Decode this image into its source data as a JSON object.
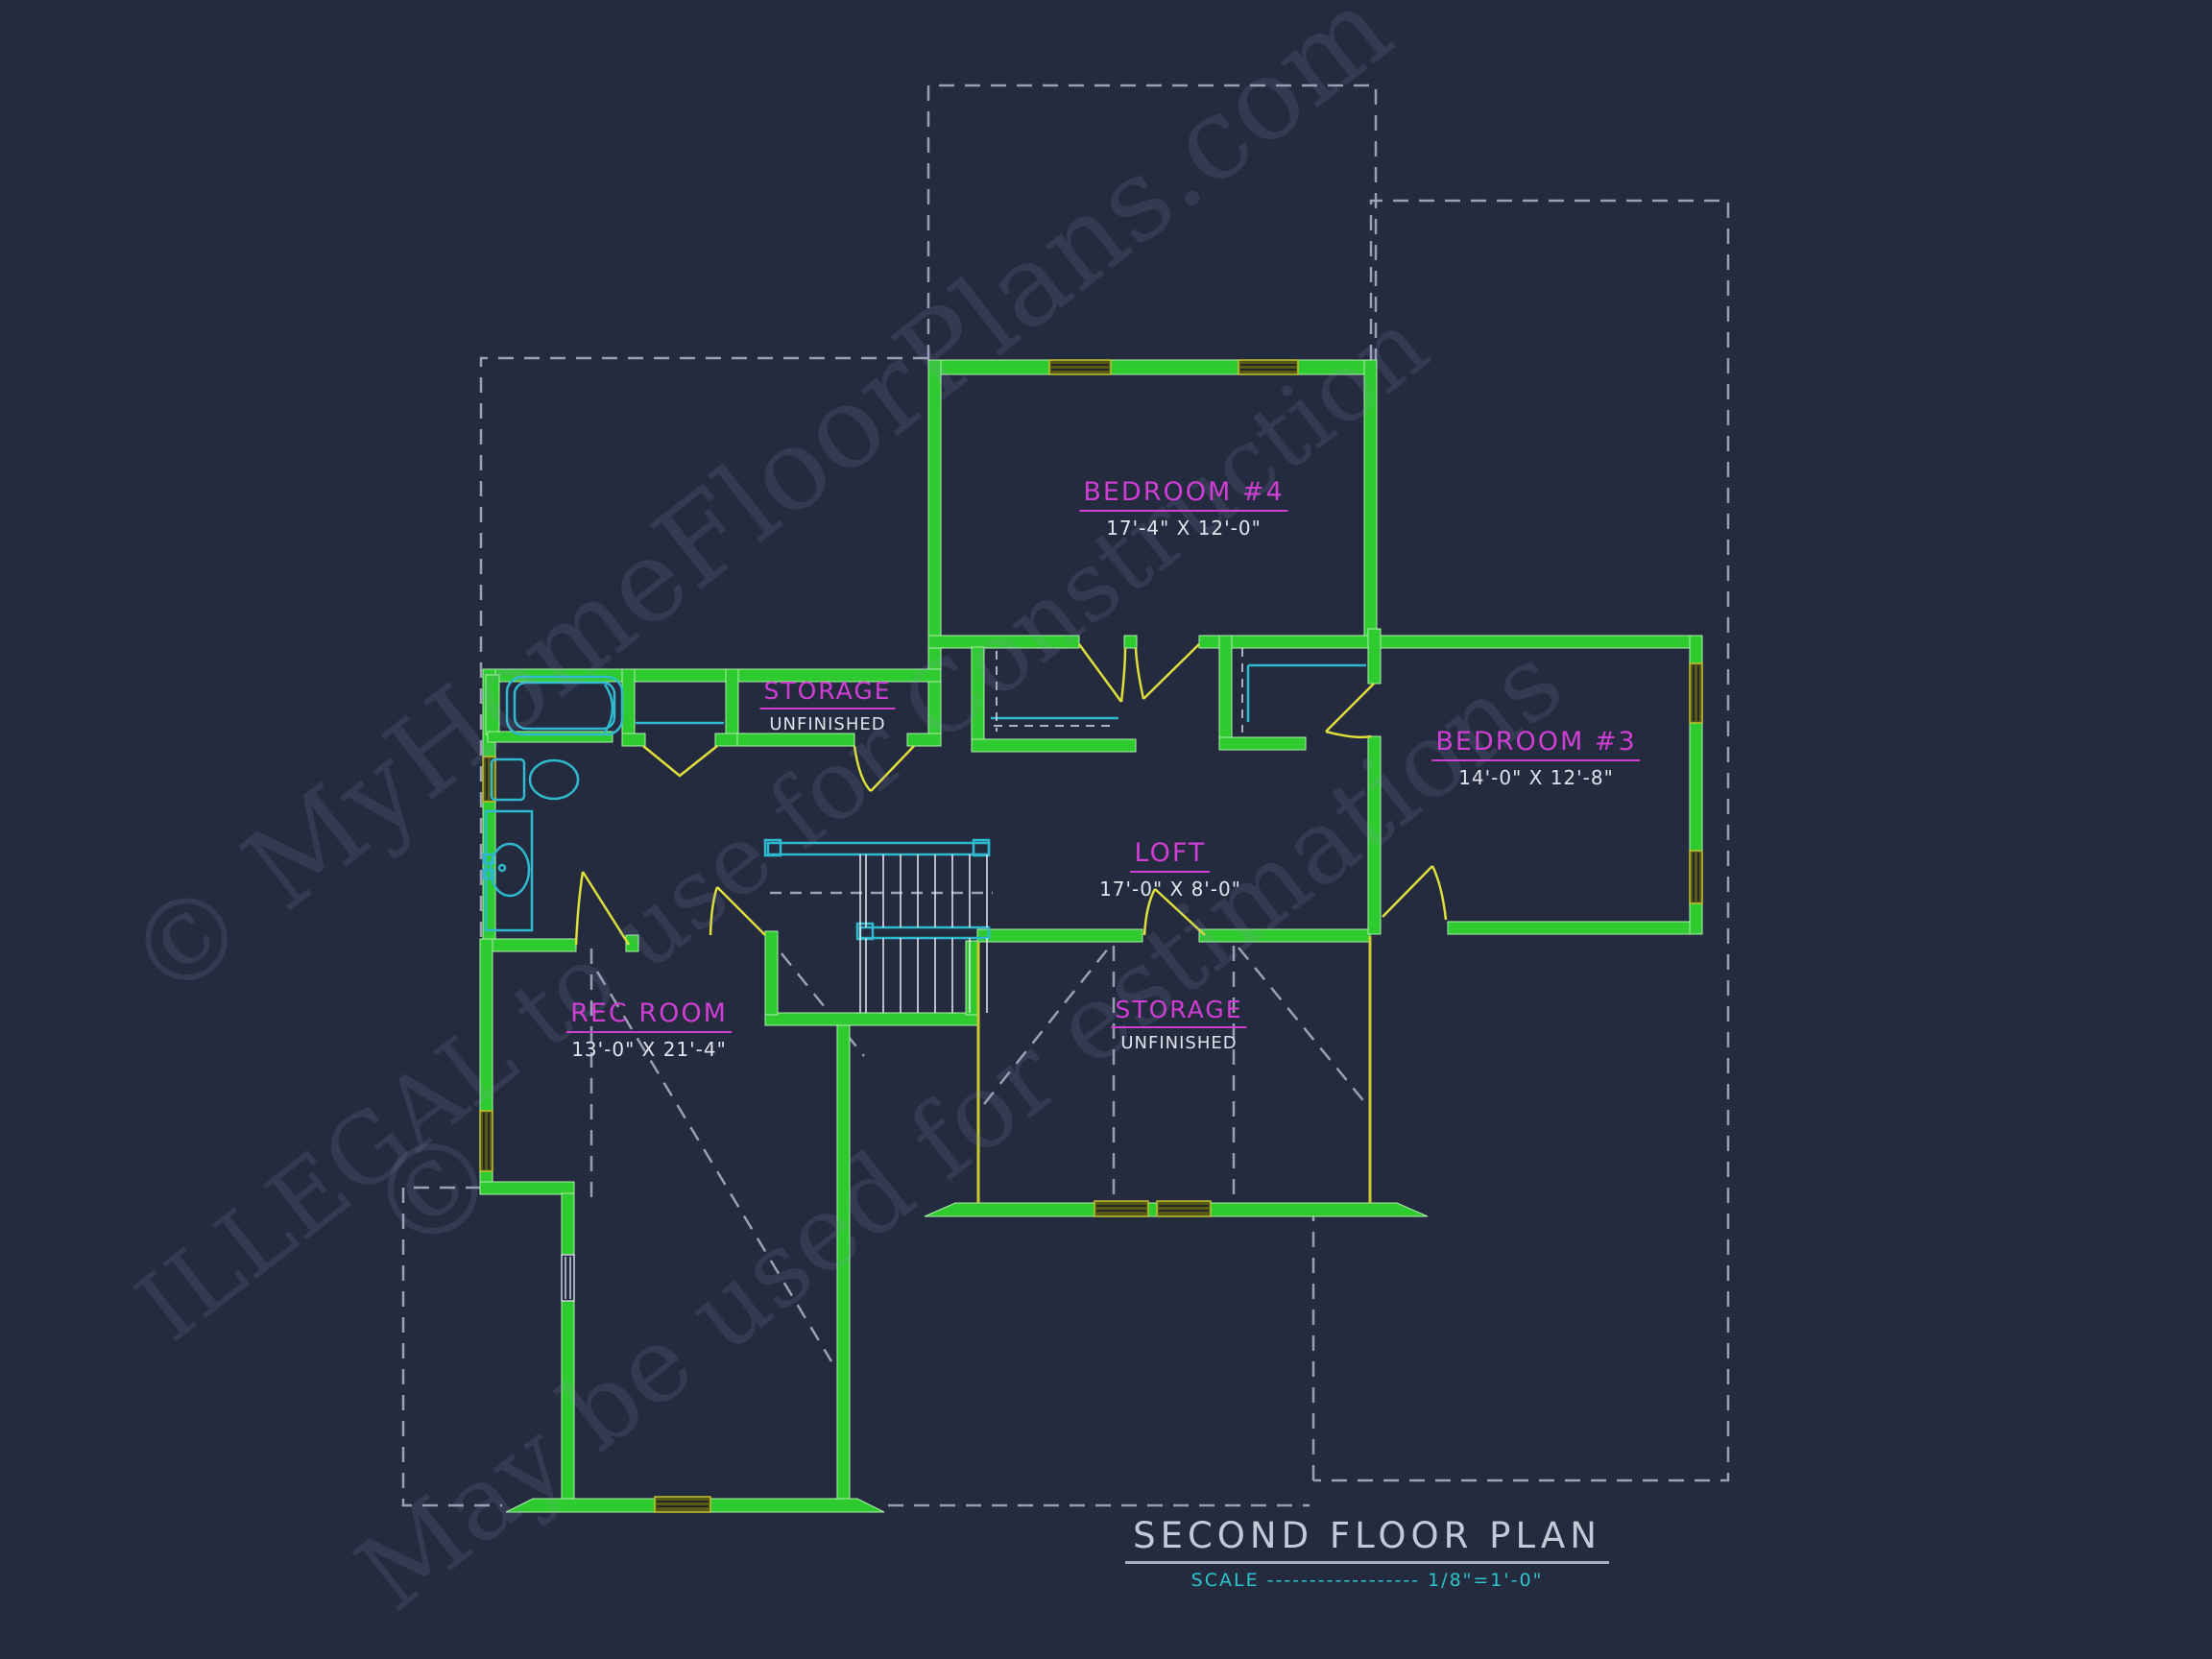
{
  "rooms": {
    "bedroom4": {
      "name": "BEDROOM #4",
      "dims": "17'-4\" X 12'-0\""
    },
    "bedroom3": {
      "name": "BEDROOM #3",
      "dims": "14'-0\" X 12'-8\""
    },
    "storage_top": {
      "name": "STORAGE",
      "dims": "UNFINISHED"
    },
    "loft": {
      "name": "LOFT",
      "dims": "17'-0\" X 8'-0\""
    },
    "rec_room": {
      "name": "REC ROOM",
      "dims": "13'-0\" X 21'-4\""
    },
    "storage_bottom": {
      "name": "STORAGE",
      "dims": "UNFINISHED"
    }
  },
  "title_block": {
    "title": "SECOND FLOOR PLAN",
    "scale_line": "SCALE ------------------ 1/8\"=1'-0\""
  },
  "watermarks": {
    "line1": "© MyHomeFloorPlans.com",
    "line2": "ILLEGAL to use for Construction",
    "line3": "May be used for estimations",
    "symbol": "©"
  },
  "colors": {
    "background": "#252b3e",
    "wall_green": "#2fca2f",
    "window_olive": "#c2c22e",
    "door_yellow": "#dede3c",
    "fixture_cyan": "#2fb9cf",
    "label_magenta": "#d03fd4",
    "dim_text": "#dfe3ec",
    "roof_dash_gray": "#98a0b4",
    "title_gray": "#c3c9d6",
    "scale_cyan": "#2cc6cc"
  }
}
